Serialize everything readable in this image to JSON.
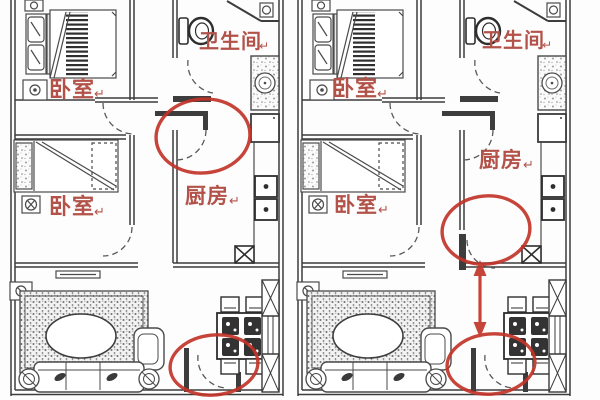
{
  "figure": {
    "kind": "apartment-floor-plan-comparison",
    "background": "#fdfdfd",
    "plan_count": 2
  },
  "colors": {
    "wall": "#3d3d3d",
    "furniture_line": "#4a4a4a",
    "room_label": "#b25249",
    "annotation_red": "#c13428"
  },
  "return_mark": "↵",
  "plans": [
    {
      "name": "plan-left",
      "rooms": {
        "bedroom_top": "卧室",
        "bathroom": "卫生间",
        "bedroom_mid": "卧室",
        "kitchen": "厨房"
      },
      "annotations": [
        {
          "shape": "ellipse",
          "highlights": "kitchen-entry-door"
        },
        {
          "shape": "ellipse",
          "highlights": "apartment-entry-door"
        }
      ]
    },
    {
      "name": "plan-right",
      "rooms": {
        "bedroom_top": "卧室",
        "bathroom": "卫生间",
        "bedroom_mid": "卧室",
        "kitchen": "厨房"
      },
      "annotations": [
        {
          "shape": "ellipse",
          "highlights": "kitchen-side-door"
        },
        {
          "shape": "double-arrow",
          "highlights": "door-relocation-path"
        },
        {
          "shape": "ellipse",
          "highlights": "apartment-entry-door"
        }
      ]
    }
  ]
}
